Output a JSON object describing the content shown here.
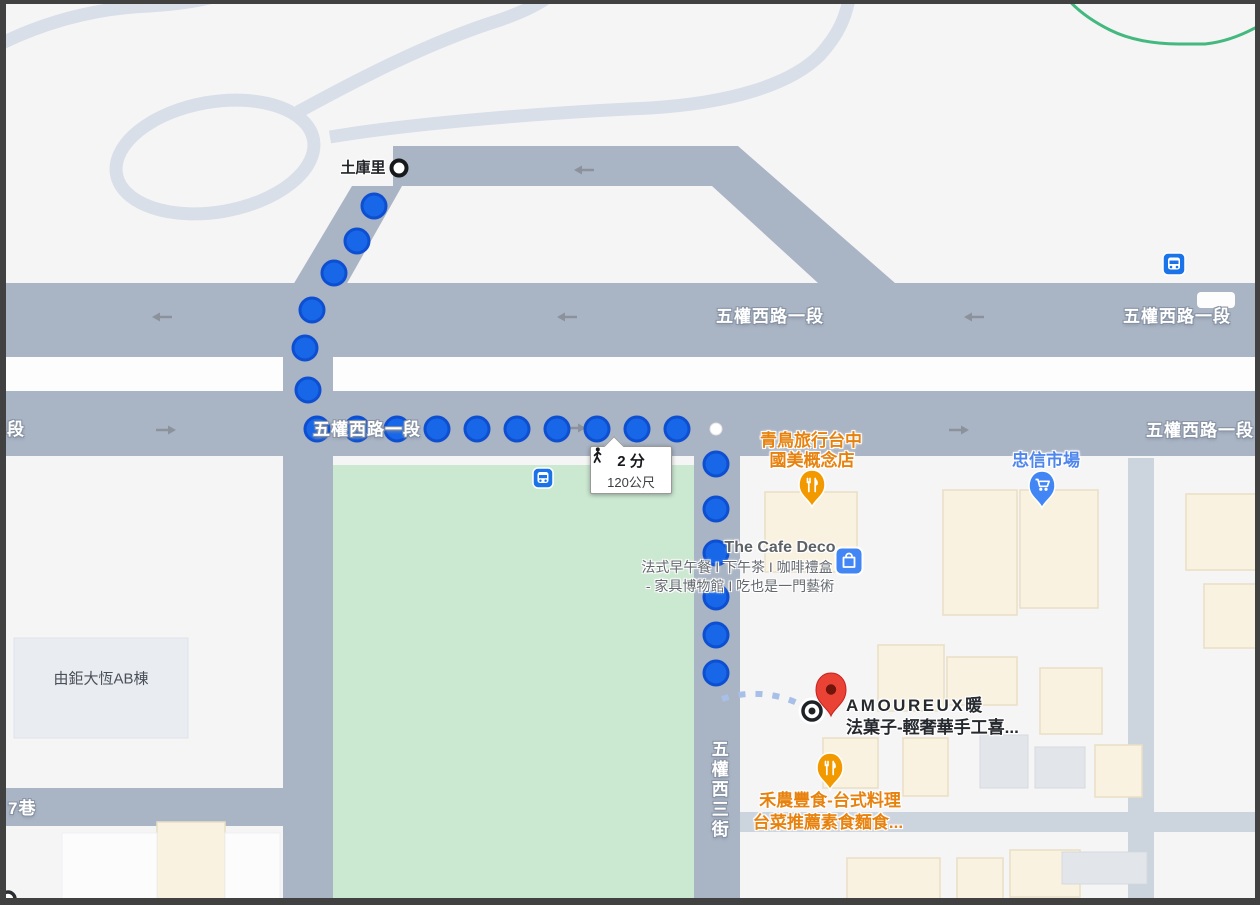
{
  "tooltip": {
    "walk_time": "2 分",
    "walk_distance": "120公尺"
  },
  "stops": {
    "start_stop_name": "土庫里"
  },
  "roads": {
    "wuquan_rd_top_center": "五權西路一段",
    "wuquan_rd_top_right": "五權西路一段",
    "wuquan_rd_bottom_left_partial": "段",
    "wuquan_rd_bottom_center": "五權西路一段",
    "wuquan_rd_bottom_right": "五權西路一段",
    "wuquan_3rd_street": "五權西三街",
    "lane_7": "7巷"
  },
  "places": {
    "travel_shop_line1": "青鳥旅行台中",
    "travel_shop_line2": "國美概念店",
    "market": "忠信市場",
    "cafe_name": "The Cafe Deco",
    "cafe_desc1": "法式早午餐 I 下午茶 I 咖啡禮盒",
    "cafe_desc2": "- 家具博物館 I 吃也是一門藝術",
    "building_left": "由鉅大恆AB棟",
    "destination_line1": "AMOUREUX暖",
    "destination_line2": "法菓子-輕奢華手工喜...",
    "restaurant_line1": "禾農豐食-台式料理",
    "restaurant_line2": "台菜推薦素食麵食..."
  },
  "icons": {
    "walking_icon": "pedestrian walking figure",
    "bus_stop_icon": "blue rounded square with bus",
    "shopping_bag_icon": "blue rounded square with bag",
    "restaurant_pin_icon": "orange pin with fork and knife",
    "shopping_pin_icon": "blue pin with shopping cart",
    "destination_pin_icon": "red map pin",
    "route_start_icon": "white circle with black ring",
    "route_end_icon": "target circle"
  },
  "colors": {
    "route_dot_fill": "#1767e8",
    "route_dot_stroke": "#0d4fd0",
    "road_fill": "#a9b4c4",
    "park_green": "#cbe8d1",
    "poi_orange": "#e8820e",
    "poi_blue": "#4e86ee",
    "destination_red": "#ea4335",
    "building_cream": "#f9f2e0",
    "frame_dark": "#414141",
    "bike_path_green": "#43b87f"
  }
}
